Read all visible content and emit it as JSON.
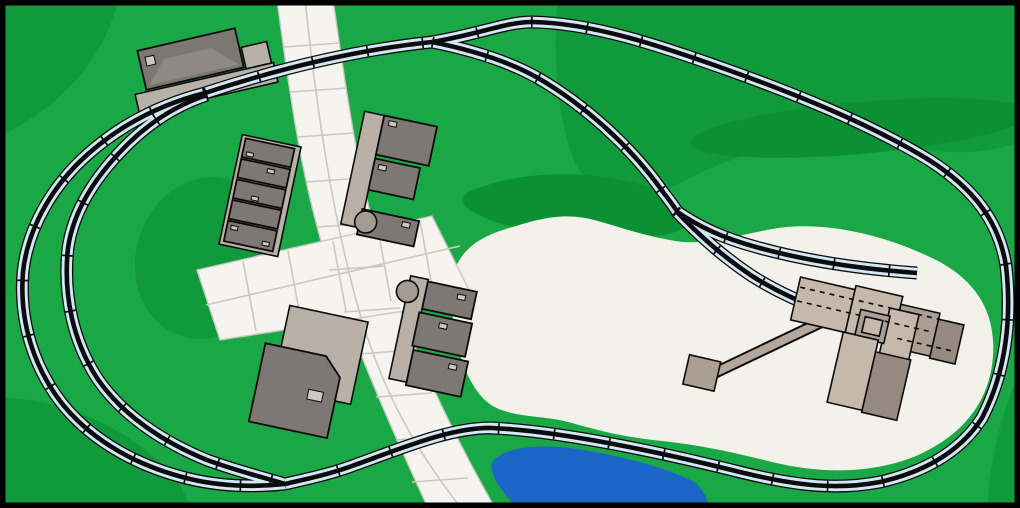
{
  "scene": {
    "type": "model-railroad-track-plan",
    "elements": [
      "grass",
      "hill-shading",
      "gravel-clearing",
      "streets",
      "pond",
      "mainline-loop",
      "passing-siding",
      "station-track",
      "industry-lead",
      "mine-spur",
      "stub-spur",
      "passenger-station",
      "station-platform",
      "town-block-west",
      "town-block-east",
      "town-block-south",
      "warehouse",
      "mine-complex",
      "conveyor",
      "conveyor-pad",
      "storage-tanks"
    ]
  },
  "counts": {
    "town_buildings_west": 5,
    "town_buildings_east": 3,
    "town_buildings_south": 3,
    "stub_tracks": 2,
    "storage_tanks": 2
  },
  "colors": {
    "grass": "#1aa846",
    "hill": "#109a3b",
    "hill_dark": "#0b9034",
    "street": "#f5f4ef",
    "street_grid": "#c9c9c2",
    "clearing": "#f2f1ea",
    "water": "#1b65c6",
    "roadbed": "#d3e7f5",
    "rail": "#0c0c0c",
    "building_dark": "#7d7873",
    "building_trim": "#8f8a84",
    "roof": "#7c7772",
    "base_tan": "#b9b1a8",
    "mine_light": "#c6b8ab",
    "mine_mid": "#ab9e92",
    "mine_dark": "#968a80",
    "tank": "#a49c93",
    "outline": "#0c0c0c",
    "frame": "#000000"
  }
}
